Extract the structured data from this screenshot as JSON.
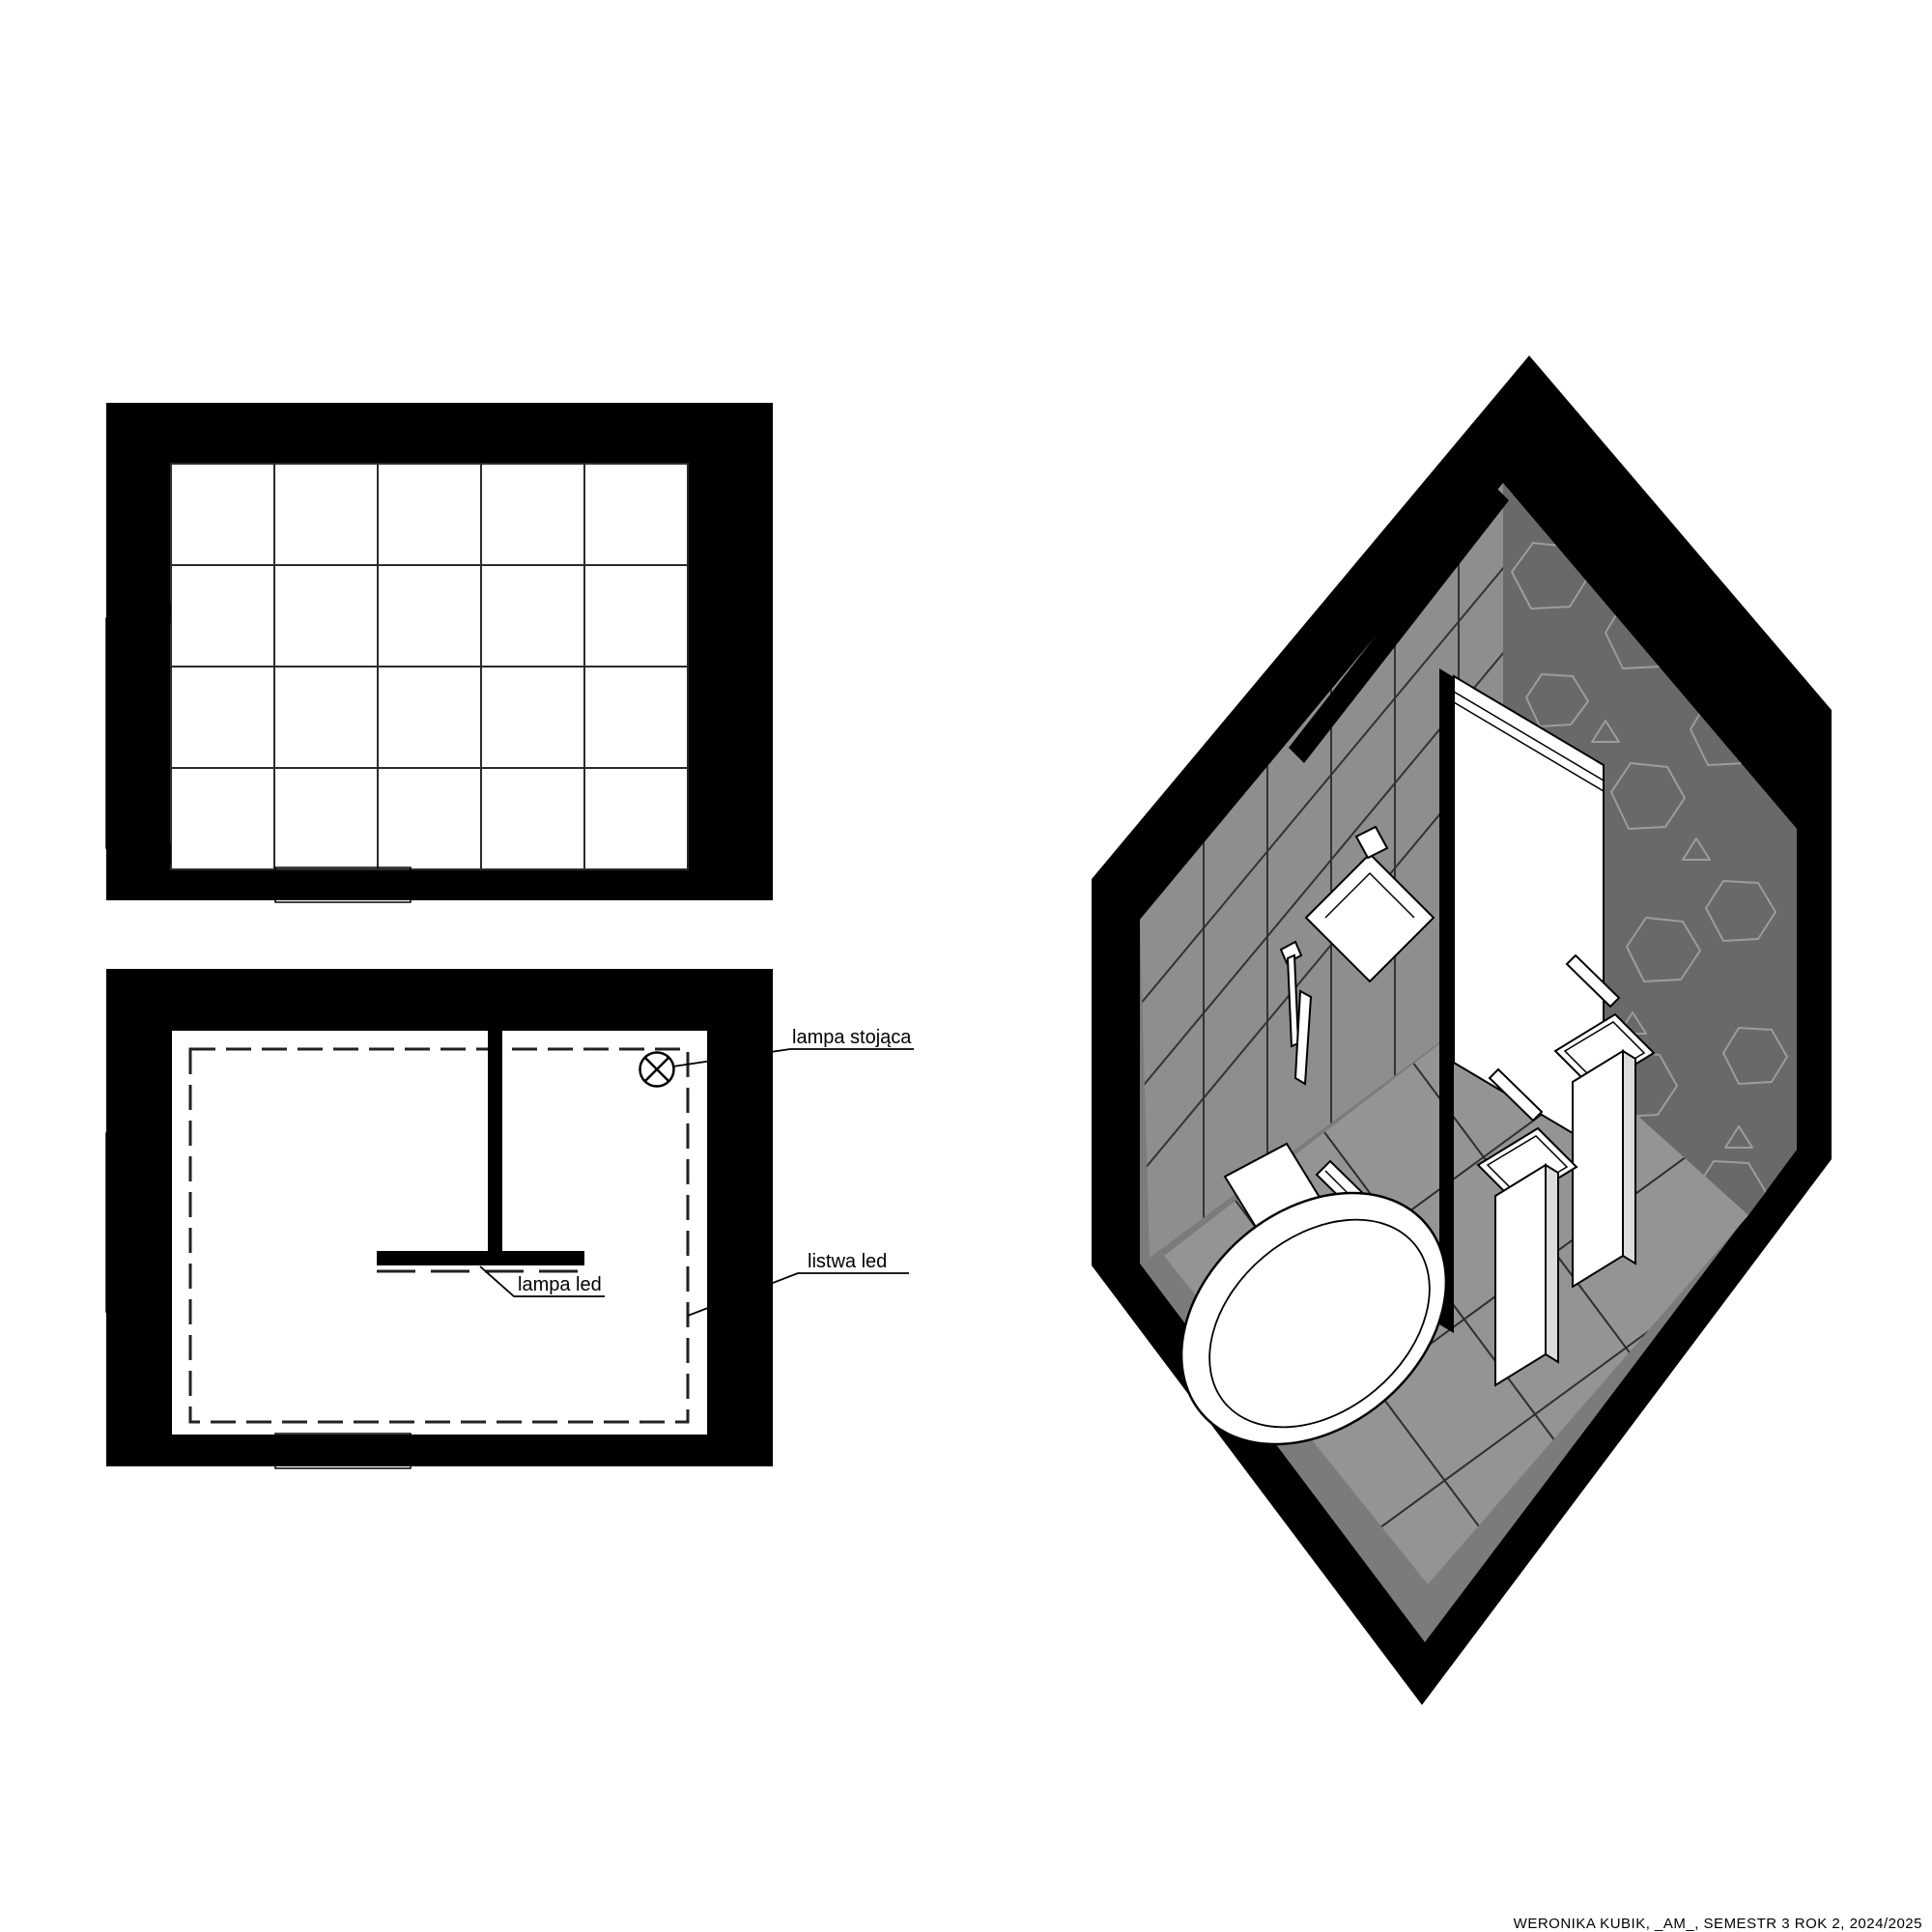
{
  "page": {
    "background_color": "#ffffff",
    "footer_caption": "WERONIKA KUBIK, _AM_, SEMESTR 3 ROK 2, 2024/2025"
  },
  "colors": {
    "wall_black": "#000000",
    "paper_white": "#ffffff",
    "tile_line": "#2b2b2b",
    "axon_left_wall": "#8e8e8e",
    "axon_stone_wall": "#696969",
    "axon_stone_outline": "#9c9c9c",
    "axon_floor": "#949494",
    "axon_skirt": "#7b7b7b",
    "fixture_white": "#ffffff",
    "basin_inner": "#ededed",
    "pedestal_side": "#dcdcdc"
  },
  "floor_plan": {
    "tile_columns": 5,
    "tile_rows": 4
  },
  "ceiling_plan": {
    "labels": {
      "lampa_stojaca": "lampa stojąca",
      "listwa_led": "listwa led",
      "lampa_led": "lampa led"
    },
    "symbols": {
      "lamp_point": "circle-x-lamp-symbol"
    }
  },
  "axonometric": {
    "fixtures": [
      "bathtub-egg",
      "washbasin-pedestal-front",
      "washbasin-pedestal-rear",
      "mirror-panel",
      "glass-partition",
      "shower-handset",
      "wall-shelf",
      "floor-led-strip"
    ]
  }
}
